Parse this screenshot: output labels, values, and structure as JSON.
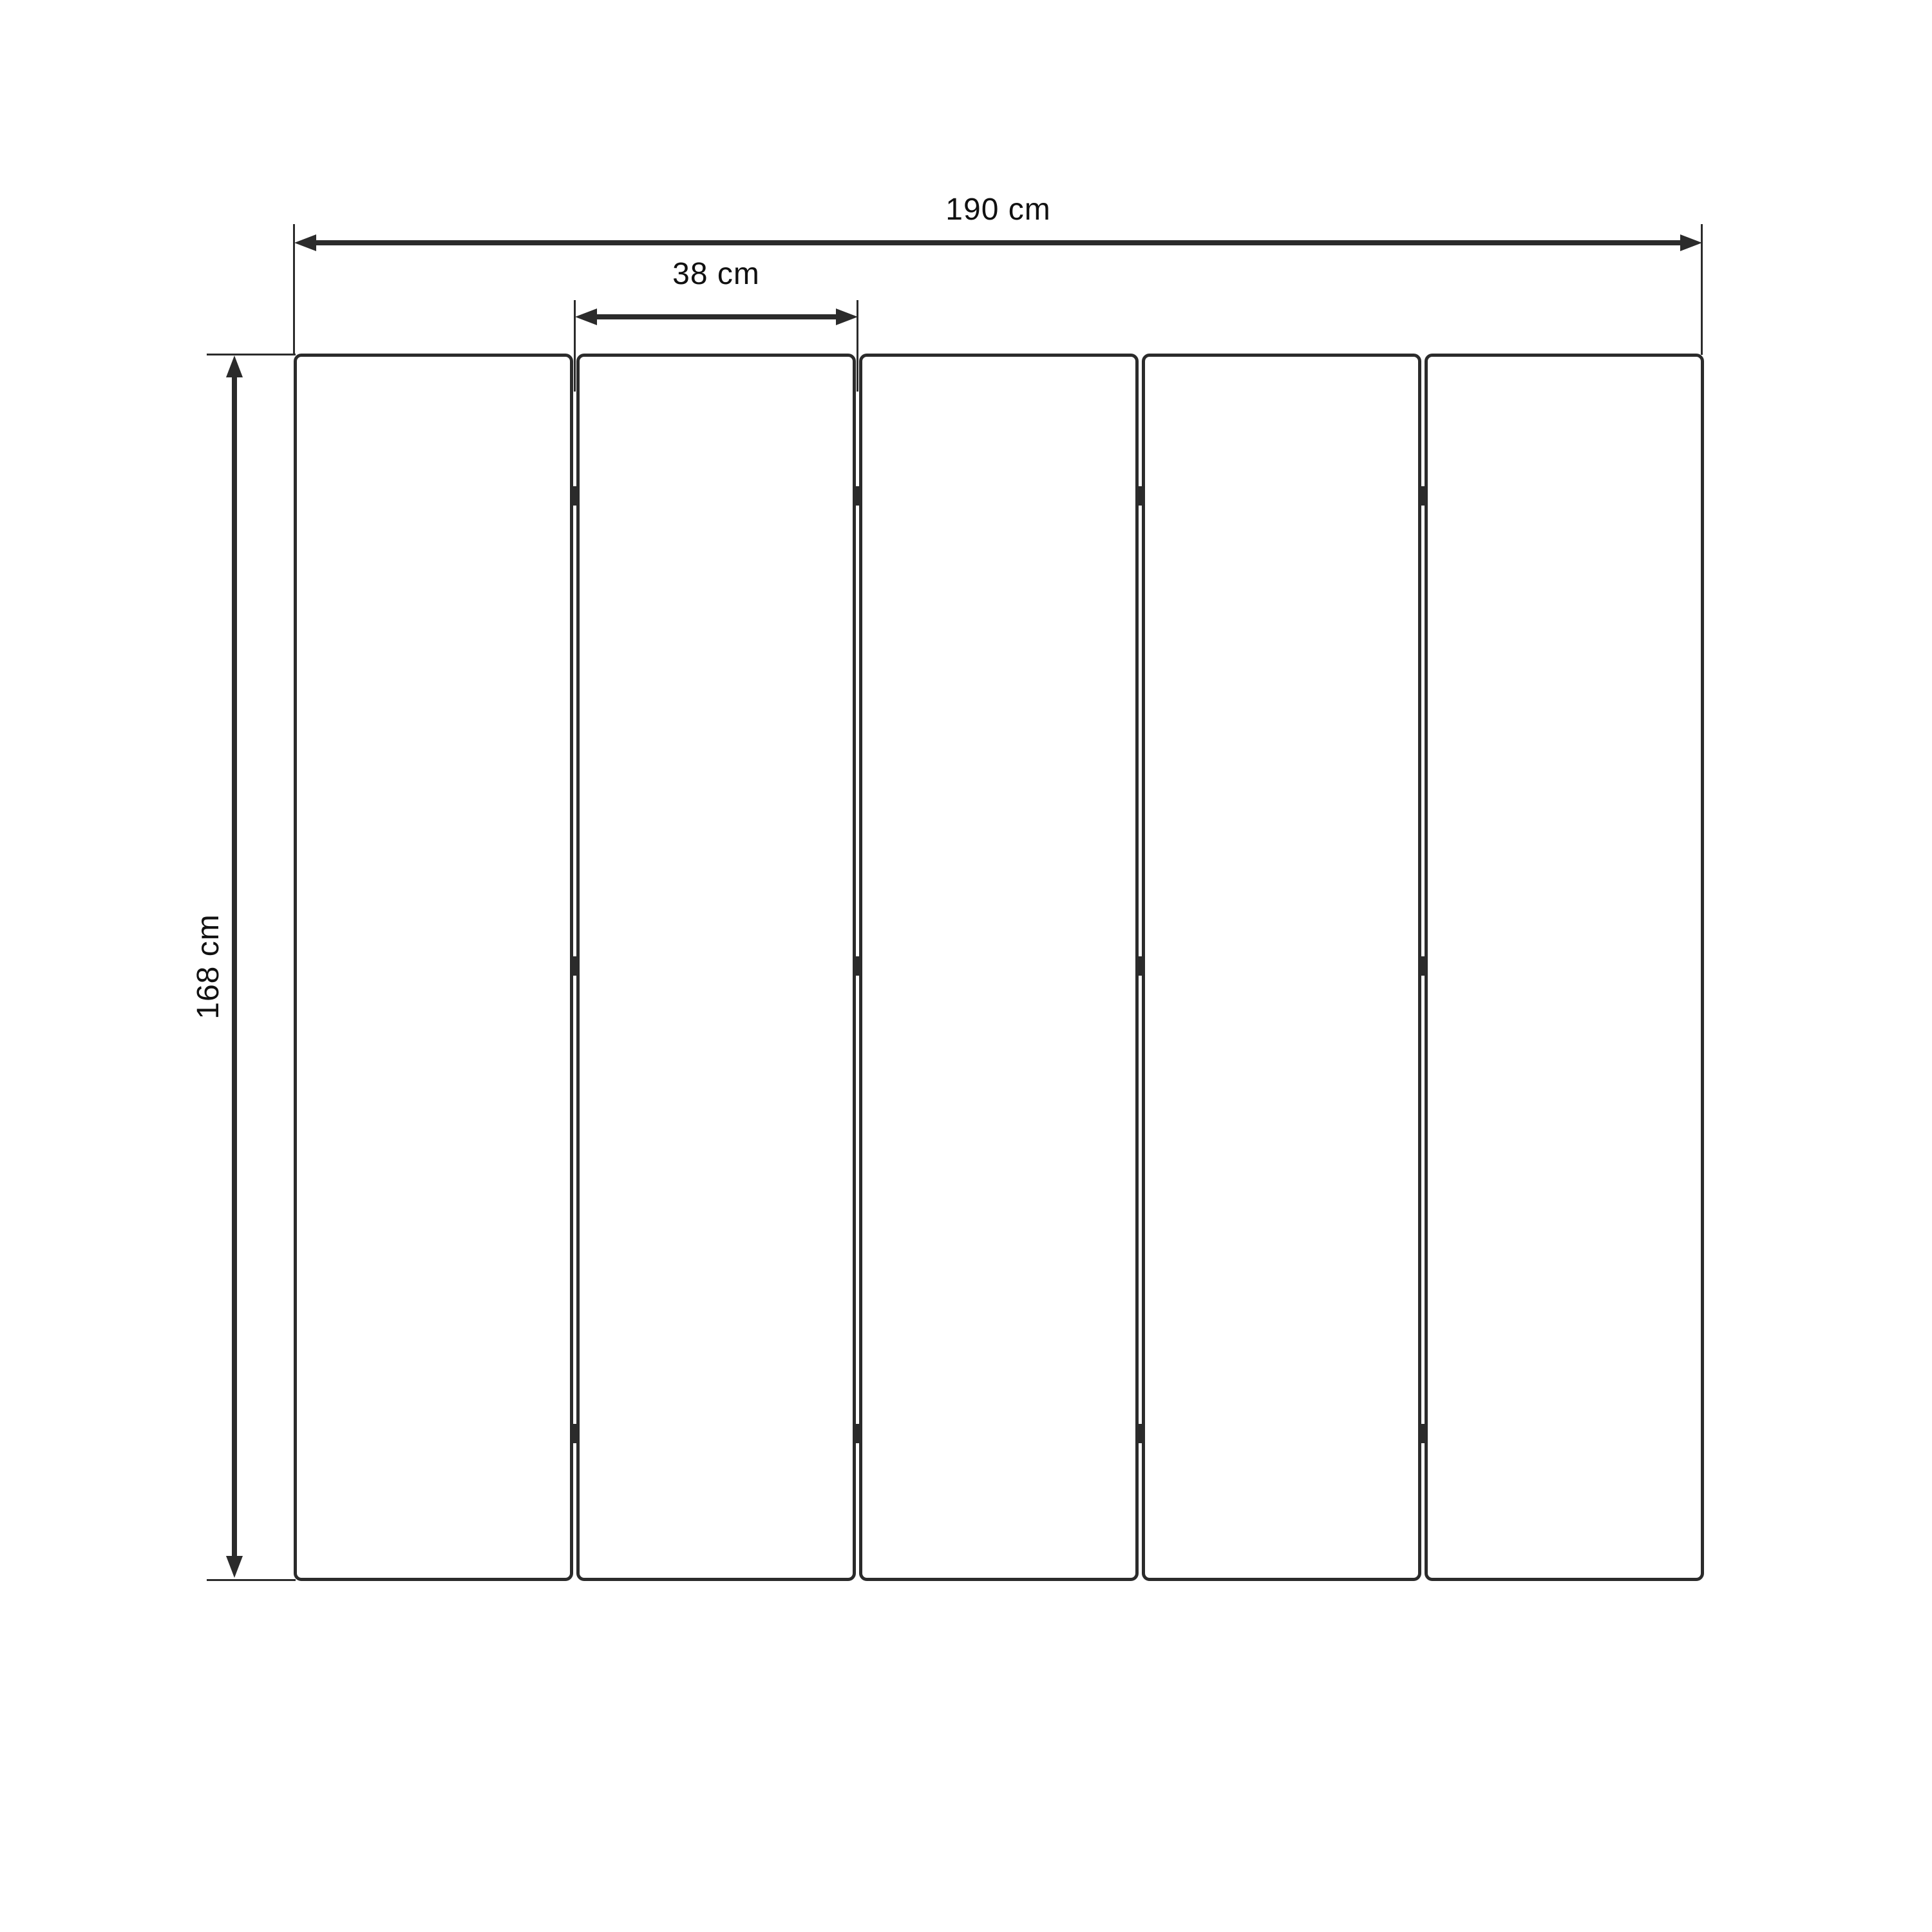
{
  "diagram": {
    "background": "#ffffff",
    "line_color": "#2b2b2b",
    "text_color": "#111111",
    "panels": {
      "count": 5,
      "hinge_rows": 3
    },
    "dimensions": {
      "total_width": "190 cm",
      "panel_width": "38 cm",
      "height": "168 cm"
    }
  }
}
